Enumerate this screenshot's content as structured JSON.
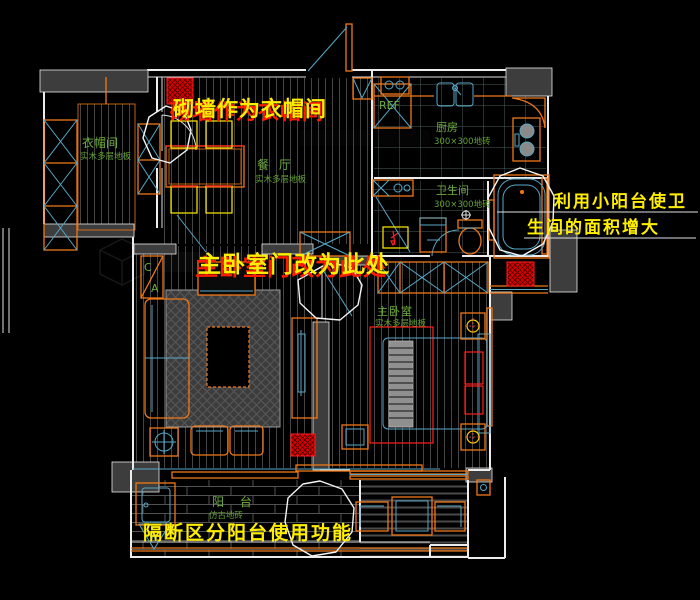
{
  "annotations": {
    "build_wall_note": "砌墙作为衣帽间",
    "bedroom_door_note": "主卧室门改为此处",
    "small_balcony_note_line1": "利用小阳台使卫",
    "small_balcony_note_line2": "生间的面积增大",
    "partition_note": "隔断区分阳台使用功能"
  },
  "rooms": {
    "cloakroom": {
      "name": "衣帽间",
      "floor": "实木多层地板"
    },
    "dining": {
      "name": "餐 厅",
      "floor": "实木多层地板"
    },
    "kitchen": {
      "name": "厨房",
      "floor": "300×300地砖"
    },
    "bathroom": {
      "name": "卫生间",
      "floor": "300×300地砖"
    },
    "bedroom": {
      "name": "主卧室",
      "floor": "实木多层地板"
    },
    "balcony": {
      "name": "阳 台",
      "floor": "仿古地砖"
    }
  },
  "markers": {
    "fridge": "REF",
    "washer": "W",
    "elevation_top": "C",
    "elevation_bottom": "A"
  },
  "colors": {
    "background": "#000000",
    "wall_line": "#ececec",
    "wall_fill": "#3d3d3d",
    "furniture": "#f07818",
    "detail": "#58a8c8",
    "room_label": "#6fae3e",
    "note_yellow": "#ffee00",
    "note_red": "#ff1a00",
    "column_red": "#d80000",
    "chair_yellow": "#ffee00"
  }
}
